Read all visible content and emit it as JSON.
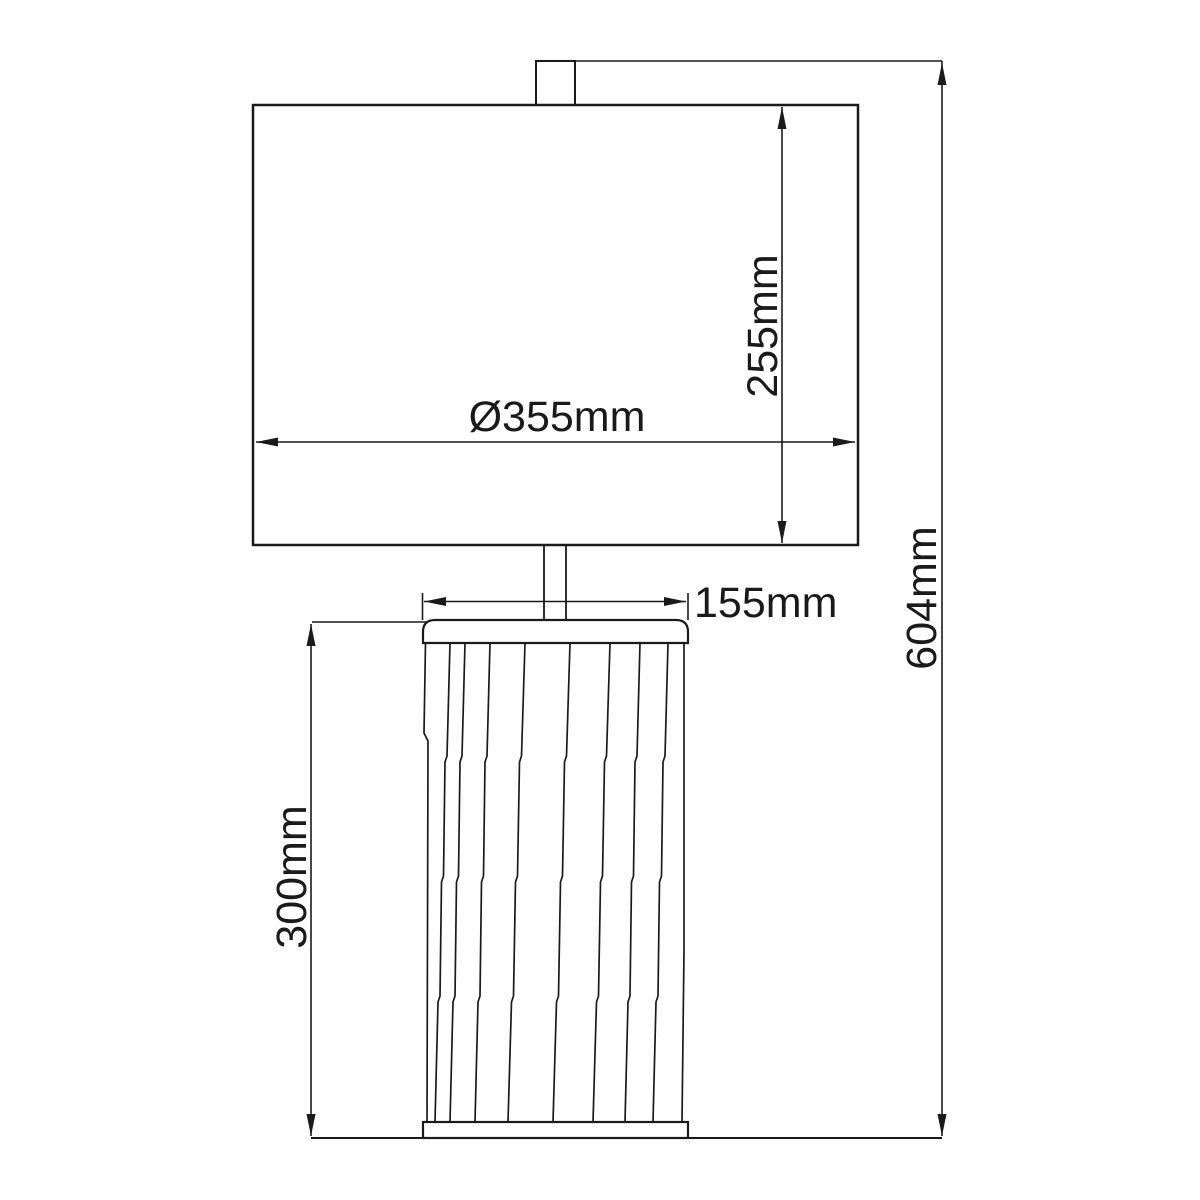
{
  "labels": {
    "shade_diameter": "Ø355mm",
    "shade_height": "255mm",
    "base_top_width": "155mm",
    "base_height": "300mm",
    "overall_height": "604mm"
  },
  "colors": {
    "line": "#1a1a1a",
    "background": "#ffffff"
  }
}
